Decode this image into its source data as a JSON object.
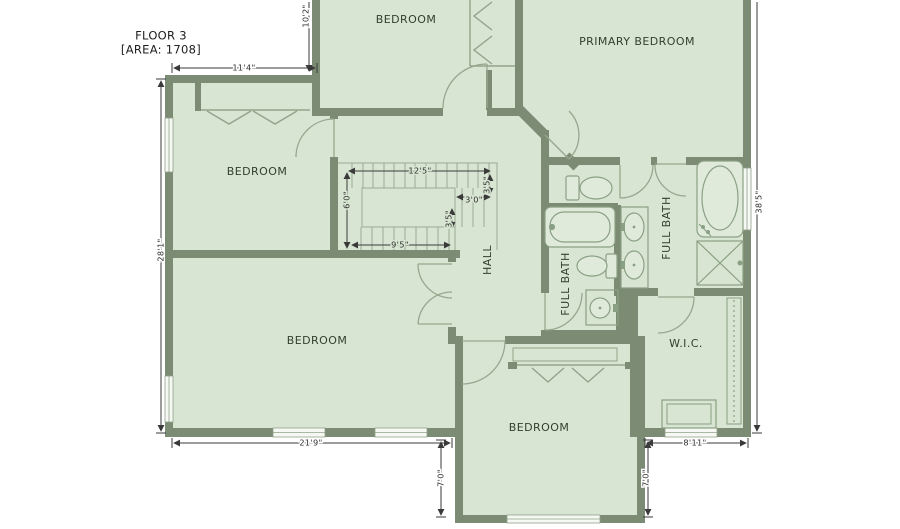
{
  "title": {
    "floor": "FLOOR 3",
    "area": "[AREA: 1708]"
  },
  "rooms": {
    "bedroom_top": "BEDROOM",
    "primary_bedroom": "PRIMARY BEDROOM",
    "bedroom_left": "BEDROOM",
    "bedroom_big": "BEDROOM",
    "bedroom_bottom": "BEDROOM",
    "hall": "HALL",
    "full_bath_left": "FULL BATH",
    "full_bath_right": "FULL BATH",
    "wic": "W.I.C."
  },
  "dimensions": {
    "top_width": "11'4\"",
    "top_height": "10'2\"",
    "left_height": "28'1\"",
    "bottom_width": "21'9\"",
    "bottom_left_height": "7'0\"",
    "bottom_right_height": "7'0\"",
    "bottom_right_width": "8'11\"",
    "right_height": "38'5\"",
    "stair_top_width": "12'5\"",
    "stair_left_height": "6'0\"",
    "stair_bottom_width": "9'5\"",
    "stair_return_width": "3'0\"",
    "stair_right_height": "3'5\"",
    "stair_mid_height": "3'5\""
  },
  "colors": {
    "wall": "#7c8b73",
    "floor": "#d8e5d2",
    "thin_line": "#93a38b",
    "window_fill": "#f6f9f3",
    "dimension": "#3a3a3a",
    "label_text": "#31402c",
    "background": "#ffffff"
  }
}
